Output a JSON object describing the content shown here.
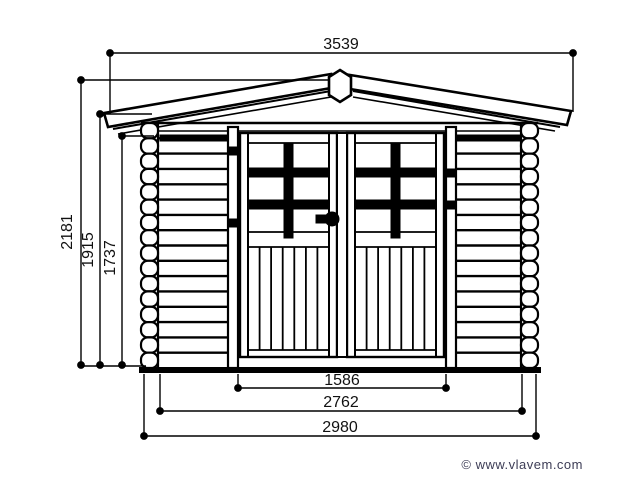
{
  "drawing": {
    "type": "front-elevation technical drawing",
    "subject": "wooden garden shed with double doors",
    "line_color": "#000000",
    "dimensions": {
      "roof_width_mm": "3539",
      "overall_height_mm": "2181",
      "eave_height_mm": "1915",
      "wall_height_mm": "1737",
      "door_width_mm": "1586",
      "wall_width_mm": "2762",
      "base_width_mm": "2980"
    }
  },
  "footer": {
    "copyright": "© www.vlavem.com",
    "color": "#3d3d56"
  }
}
